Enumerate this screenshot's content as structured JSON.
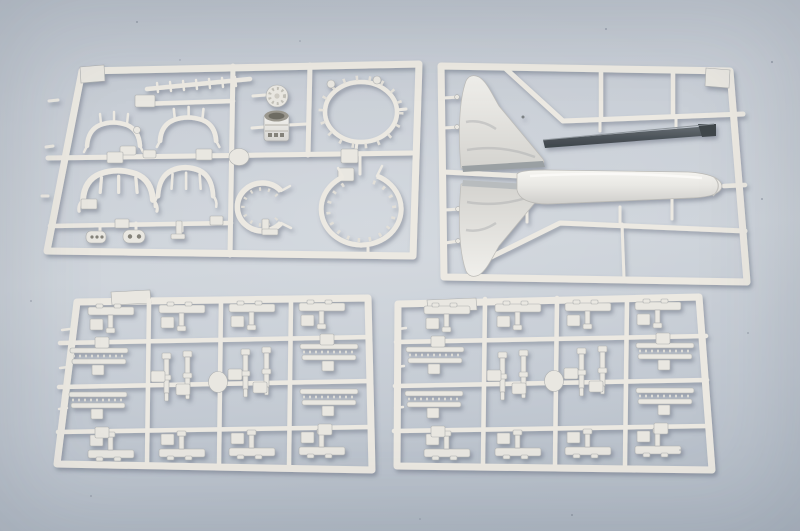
{
  "scene": {
    "type": "studio photograph",
    "subject": "Four light-gray injection-molded plastic model kit sprues (parts trees) of an aircraft model kit laid on a blue-gray studio backdrop",
    "sprue_count": 4
  },
  "colors": {
    "backdrop_top": "#bdc4cd",
    "backdrop_middle": "#cdd3da",
    "backdrop_bottom": "#b0b9c4",
    "plastic": "#ece9e2",
    "plastic_highlight": "#f4f3f0",
    "plastic_shadow": "#aeb0b0",
    "dark_part": "#4b5258"
  },
  "objects": {
    "sprue_top_left": {
      "label": "detail parts sprue with cockpit frames, ribbed rod, knurled disc, engine cylinder, two toothed intake rings, horseshoe ring and small fittings"
    },
    "sprue_top_right": {
      "label": "sprue with two vertical tail fin halves, a dark gray stabilator blade and a tapered tank half"
    },
    "sprue_bottom_left": {
      "label": "grid sprue of small rail brackets, track bars, pylon pins and a round gate disc"
    },
    "sprue_bottom_right": {
      "label": "duplicate grid sprue of small rail brackets, track bars, pylon pins and a round gate disc"
    }
  }
}
